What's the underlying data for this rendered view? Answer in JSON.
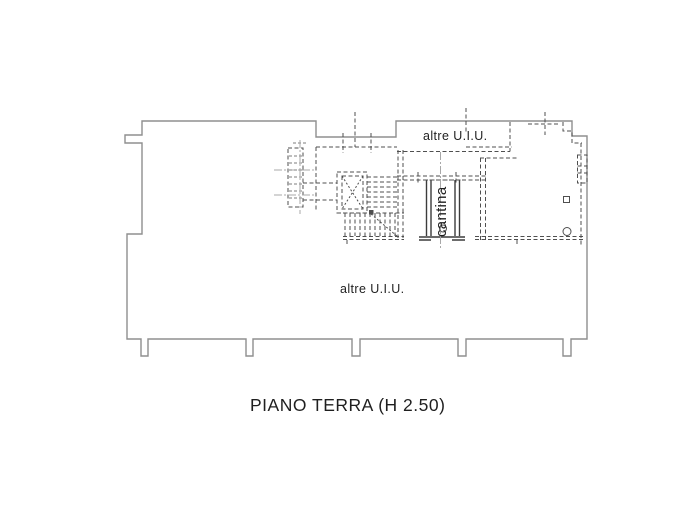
{
  "floorplan": {
    "caption": "PIANO TERRA  (H 2.50)",
    "labels": {
      "other_unit_top": "altre U.I.U.",
      "other_unit_main": "altre U.I.U.",
      "cellar_room": "cantina"
    },
    "colors": {
      "paper": "#ffffff",
      "outline": "#8f8f8f",
      "dash": "#4f4f4f",
      "dashlight": "#a8a8a8",
      "wall": "#3c3c3c",
      "text": "#1f1f1f"
    }
  }
}
